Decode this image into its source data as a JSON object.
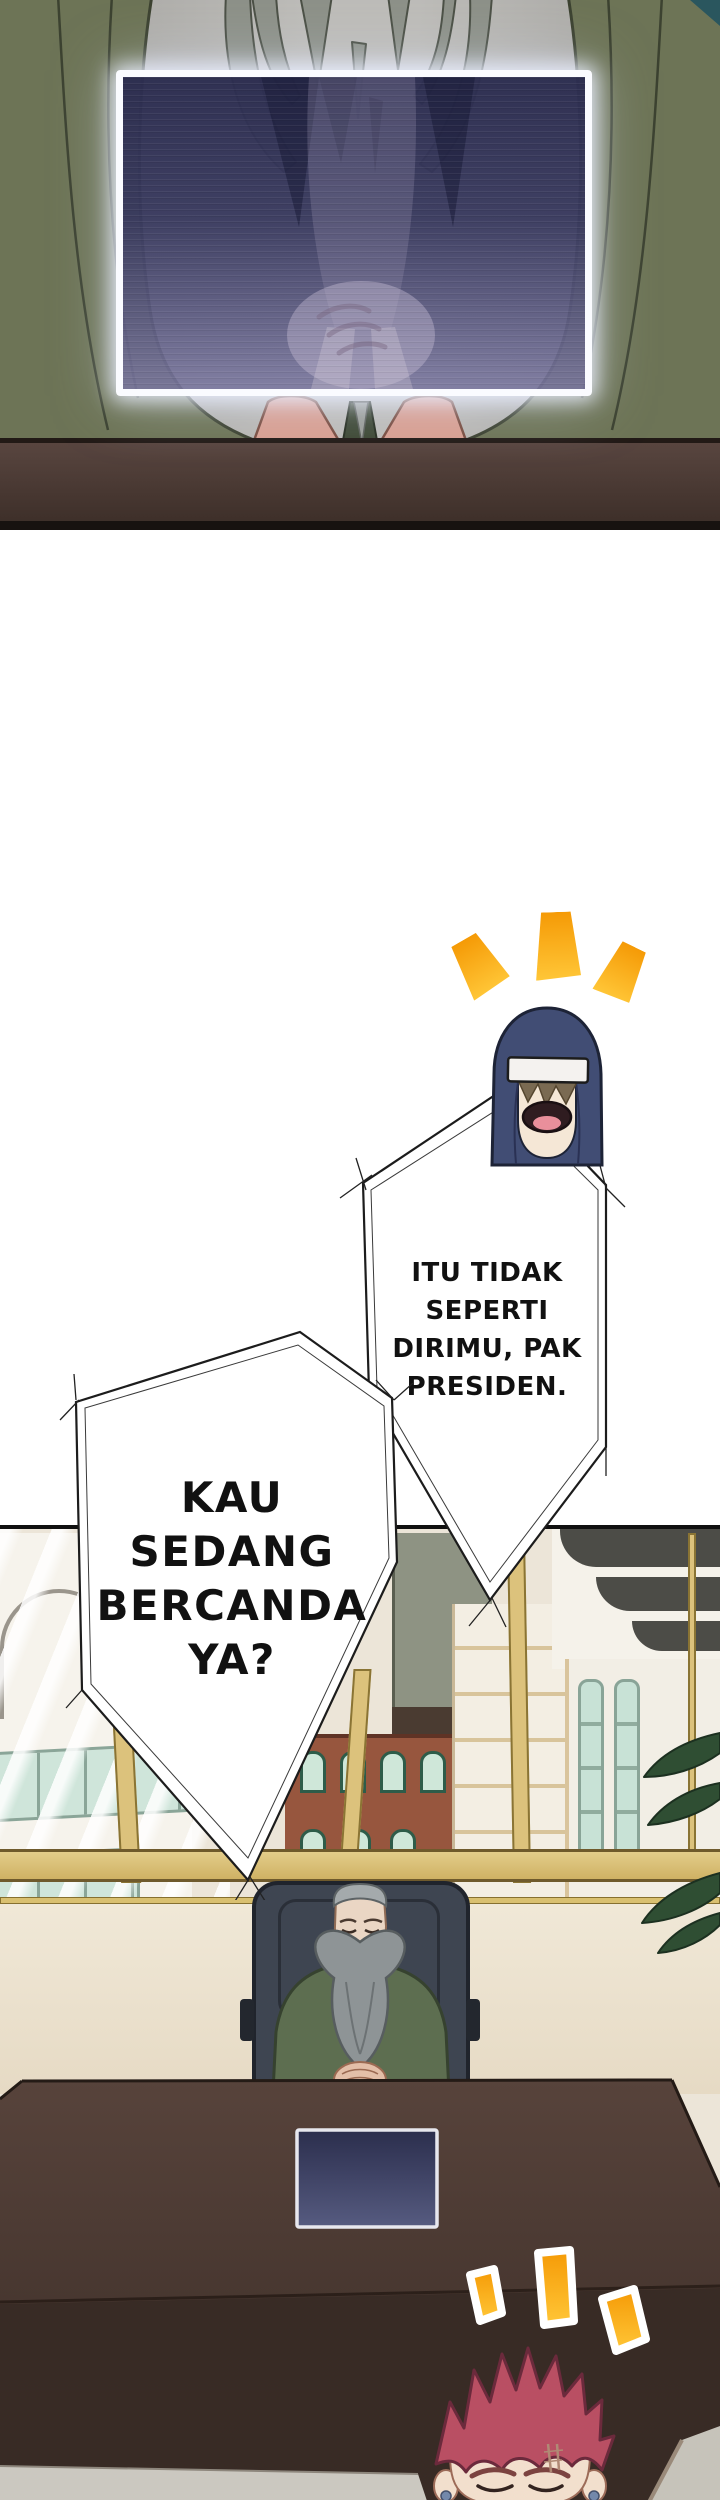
{
  "page": {
    "title": "Webtoon comic page",
    "language": "Indonesian",
    "background": "#ffffff"
  },
  "panels": {
    "top": {
      "description": "Close-up of a grey-bearded figure in a green robe, hands clasped behind a glowing translucent holographic screen above a dark wooden desk."
    },
    "bottom": {
      "description": "Presidential office with city-view windows; an old bearded president in a green robe sits in a dark chair at a large brown desk with an embedded dark screen; a red-spiky-haired character pops up at the bottom edge."
    }
  },
  "speech_bubbles": [
    {
      "speaker": "hooded-laughing-character",
      "lines": [
        "ITU TIDAK",
        "SEPERTI",
        "DIRIMU, PAK",
        "PRESIDEN."
      ]
    },
    {
      "speaker": "hooded-laughing-character",
      "lines": [
        "KAU",
        "SEDANG",
        "BERCANDA",
        "YA?"
      ]
    }
  ],
  "characters": [
    {
      "name": "hooded-laughing-character",
      "description": "Navy hooded head with white headband, fringe over eyes, laughing open mouth"
    },
    {
      "name": "president-old-man",
      "description": "Old man, grey slicked hair, long forked grey beard, green robe, hands clasped"
    },
    {
      "name": "red-spiky-haired-character",
      "description": "Red spiky hair, closed happy eyes, forehead scar, blue earrings"
    }
  ],
  "emphasis_marks": {
    "top_count": 3,
    "bottom_count": 3,
    "style": "orange excitement dashes"
  },
  "colors": {
    "accent-orange": "#f59a06",
    "accent-orange-light": "#ffc637",
    "hood-navy": "#414d74",
    "hair-red": "#b94f63",
    "robe-green": "#6d7456",
    "president-robe": "#5d6e50",
    "desk-brown": "#4e3b33",
    "desk-front": "#382b25",
    "gold-frame": "#dcc27c",
    "screen-navy": "#32335a",
    "floor-grey": "#cbc8c0",
    "panel-border": "#101010",
    "sky-cream": "#ece5d8",
    "wall-cream": "#f0e8d7",
    "skin": "#f2dfcd",
    "beard-grey": "#8e9496",
    "chair-slate": "#3e4551"
  }
}
